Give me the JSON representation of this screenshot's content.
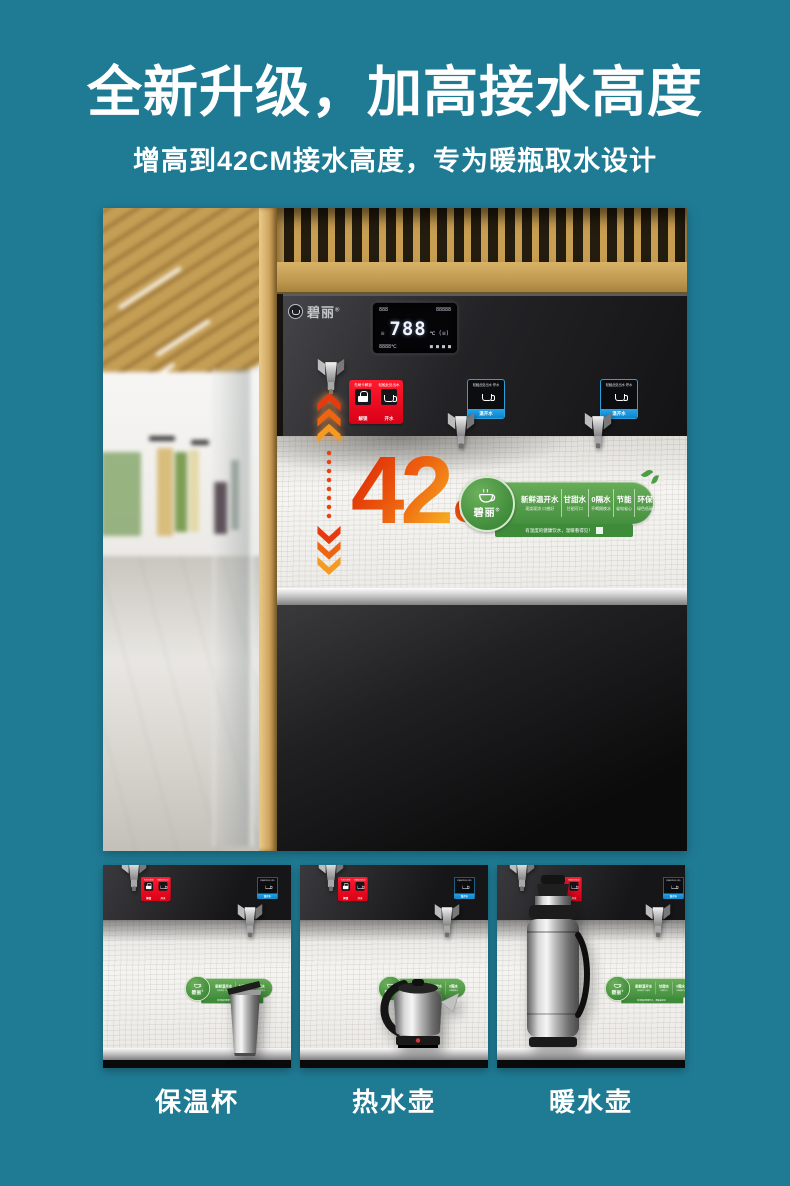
{
  "header": {
    "title": "全新升级，加高接水高度",
    "subtitle": "增高到42CM接水高度，专为暖瓶取水设计"
  },
  "machine": {
    "brand": "碧丽",
    "brand_mark": "®",
    "display": {
      "row1_left": "888",
      "row1_right": "88888",
      "side": "≡",
      "main": "788",
      "main_unit": "℃",
      "aux": "(≡)",
      "row3_left": "8888℃",
      "row3_right": "■ ■ ■ ■"
    },
    "red_label": {
      "top_left": "先刷卡解锁",
      "top_right": "轻触此处出水",
      "foot_left": "解锁",
      "foot_right": "开水"
    },
    "blue_label": {
      "top": "轻触此处出水·停水",
      "foot": "温开水"
    }
  },
  "callout": {
    "value": "42",
    "unit": "CM"
  },
  "banner": {
    "brand": "碧丽",
    "brand_mark": "®",
    "features": [
      {
        "name": "新鲜温开水",
        "sub": "现烧现凉 口感好"
      },
      {
        "name": "甘甜水",
        "sub": "甘甜可口"
      },
      {
        "name": "0隔水",
        "sub": "不喝隔夜水"
      },
      {
        "name": "节能",
        "sub": "省电省心"
      },
      {
        "name": "环保",
        "sub": "绿色低碳"
      }
    ],
    "slogan": "有温度的健康饮水，温暖看得见！"
  },
  "thumbnails": [
    {
      "label": "保温杯"
    },
    {
      "label": "热水壶"
    },
    {
      "label": "暖水壶"
    }
  ],
  "colors": {
    "teal_bg": "#1f7b94",
    "hot_red": "#e60019",
    "warm_blue": "#0a9be6",
    "banner_green": "#4f9c46",
    "orange_gradient_start": "#e23708",
    "orange_gradient_end": "#f6a51e"
  }
}
